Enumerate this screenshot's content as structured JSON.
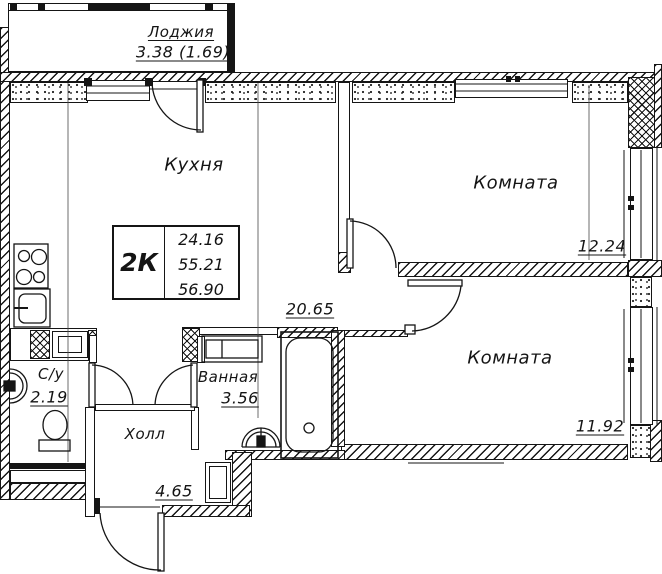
{
  "drawing": {
    "flat_table": {
      "type": "2К",
      "living_area": "24.16",
      "flat_area": "55.21",
      "total_area": "56.90"
    },
    "rooms": {
      "loggia": {
        "name": "Лоджия",
        "area": "3.38 (1.69)"
      },
      "kitchen": {
        "name": "Кухня",
        "area": "20.65"
      },
      "room1": {
        "name": "Комната",
        "area": "12.24"
      },
      "room2": {
        "name": "Комната",
        "area": "11.92"
      },
      "bathroom": {
        "name": "Ванная",
        "area": "3.56"
      },
      "wc": {
        "name": "С/у",
        "area": "2.19"
      },
      "hall": {
        "name": "Холл",
        "area": "4.65"
      }
    },
    "colors": {
      "line": "#151515",
      "background": "#ffffff"
    }
  }
}
